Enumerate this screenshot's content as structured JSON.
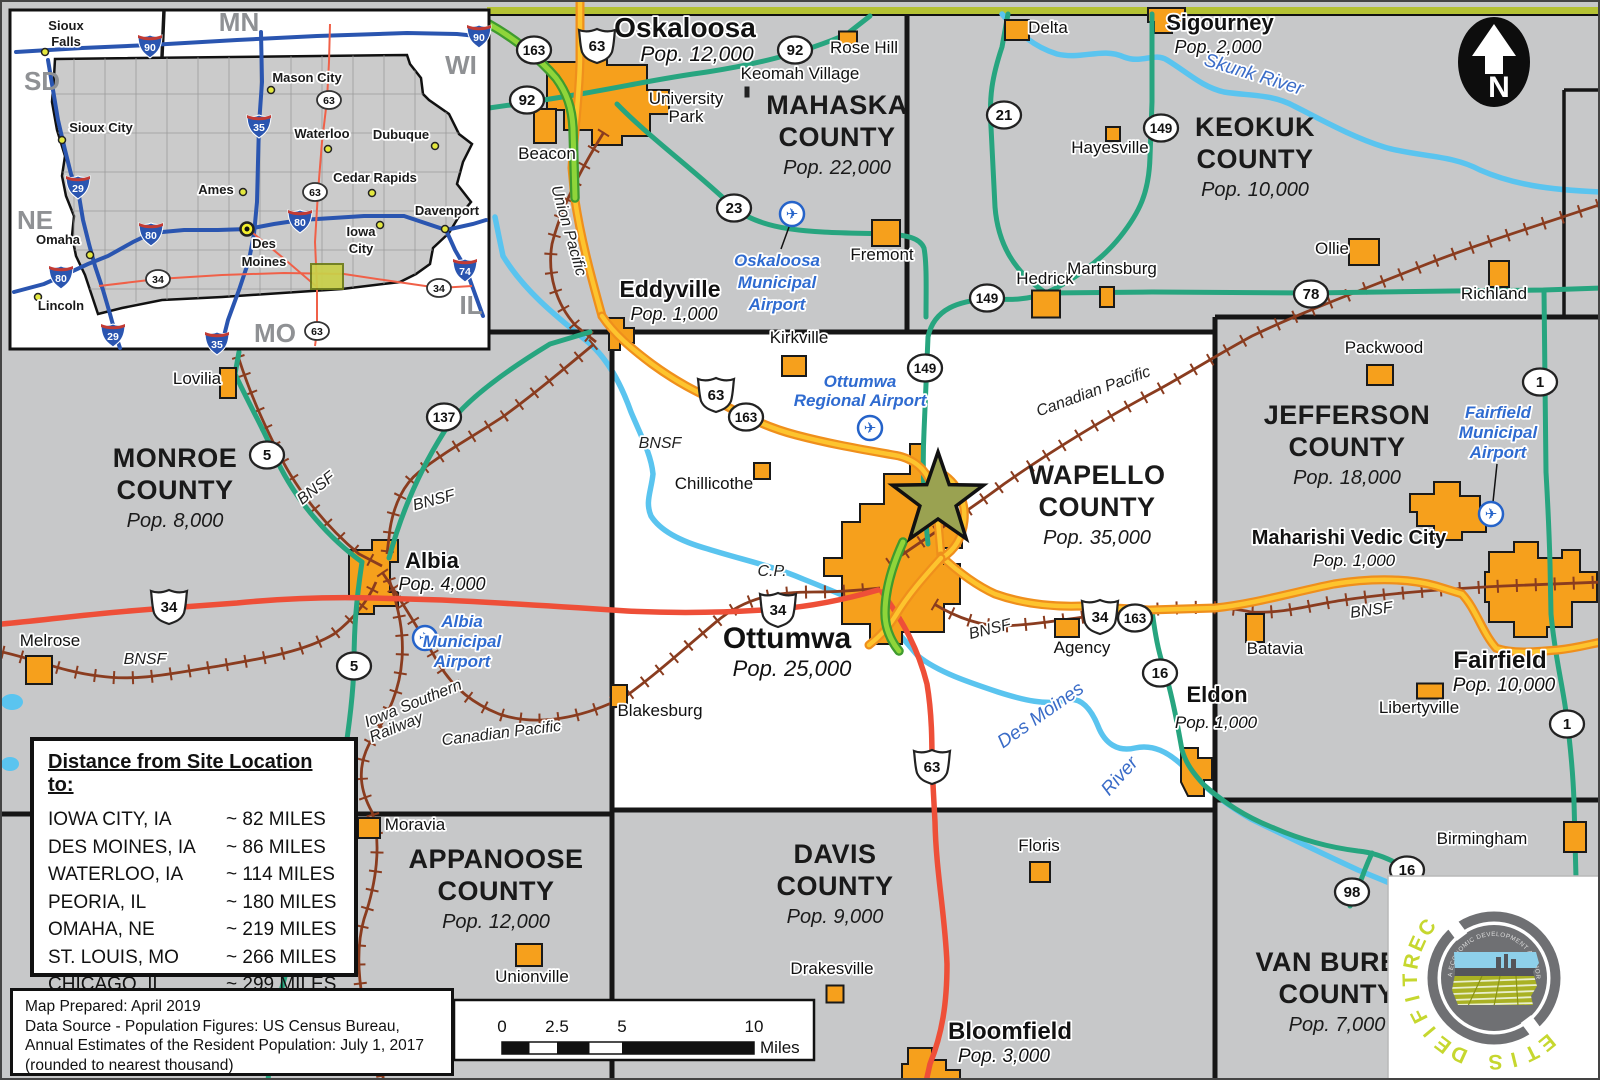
{
  "colors": {
    "town": "#f6a01c",
    "road_teal": "#27a57f",
    "road_yellow": "#fdc42e",
    "road_red": "#ee4f38",
    "road_lime": "#8fd53a",
    "rail": "#8a3c1f",
    "river": "#5ac4ef",
    "star": "#9aa251",
    "logo_green": "#c6d72f",
    "accent_olive": "#b5c234"
  },
  "map": {
    "north_label": "N",
    "site_marker": "site-location-star",
    "counties": [
      {
        "lines": [
          "MAHASKA",
          "COUNTY"
        ],
        "pop": "Pop. 22,000",
        "x": 835,
        "y": 112
      },
      {
        "lines": [
          "KEOKUK",
          "COUNTY"
        ],
        "pop": "Pop. 10,000",
        "x": 1253,
        "y": 134
      },
      {
        "lines": [
          "MONROE",
          "COUNTY"
        ],
        "pop": "Pop. 8,000",
        "x": 173,
        "y": 465
      },
      {
        "lines": [
          "WAPELLO",
          "COUNTY"
        ],
        "pop": "Pop. 35,000",
        "x": 1095,
        "y": 482
      },
      {
        "lines": [
          "JEFFERSON",
          "COUNTY"
        ],
        "pop": "Pop. 18,000",
        "x": 1345,
        "y": 422
      },
      {
        "lines": [
          "APPANOOSE",
          "COUNTY"
        ],
        "pop": "Pop. 12,000",
        "x": 494,
        "y": 866
      },
      {
        "lines": [
          "DAVIS",
          "COUNTY"
        ],
        "pop": "Pop. 9,000",
        "x": 833,
        "y": 861
      },
      {
        "lines": [
          "VAN BUREN",
          "COUNTY"
        ],
        "pop": "Pop. 7,000",
        "x": 1335,
        "y": 969
      }
    ],
    "towns": [
      {
        "n": "Oskaloosa",
        "x": 683,
        "y": 35,
        "s": 28,
        "b": 1,
        "pop": "Pop. 12,000",
        "px": 695,
        "py": 59,
        "ps": 21
      },
      {
        "n": "University Park",
        "lines": [
          "University",
          "Park"
        ],
        "x": 684,
        "y": 102,
        "s": 17,
        "dy": 18
      },
      {
        "n": "Beacon",
        "x": 545,
        "y": 157,
        "s": 17,
        "m": [
          543,
          124,
          22,
          34
        ]
      },
      {
        "n": "Keomah Village",
        "x": 798,
        "y": 77,
        "s": 17,
        "m": [
          745,
          90,
          5,
          11
        ],
        "dark": 1
      },
      {
        "n": "Rose Hill",
        "x": 862,
        "y": 51,
        "s": 17,
        "m": [
          846,
          36,
          18,
          13
        ]
      },
      {
        "n": "Delta",
        "x": 1046,
        "y": 31,
        "s": 17,
        "m": [
          1015,
          28,
          24,
          20
        ]
      },
      {
        "n": "Sigourney",
        "x": 1218,
        "y": 28,
        "s": 22,
        "b": 1,
        "pop": "Pop. 2,000",
        "px": 1216,
        "py": 51,
        "ps": 18
      },
      {
        "n": "Hayesville",
        "x": 1108,
        "y": 151,
        "s": 17,
        "m": [
          1111,
          132,
          14,
          14
        ]
      },
      {
        "n": "Hedrick",
        "x": 1043,
        "y": 282,
        "s": 17,
        "m": [
          1044,
          302,
          28,
          27
        ]
      },
      {
        "n": "Martinsburg",
        "x": 1110,
        "y": 272,
        "s": 17,
        "m": [
          1105,
          295,
          14,
          20
        ]
      },
      {
        "n": "Ollie",
        "x": 1330,
        "y": 252,
        "s": 17,
        "m": [
          1362,
          250,
          30,
          26
        ]
      },
      {
        "n": "Richland",
        "x": 1492,
        "y": 297,
        "s": 17,
        "m": [
          1497,
          272,
          20,
          26
        ]
      },
      {
        "n": "Packwood",
        "x": 1382,
        "y": 351,
        "s": 17,
        "m": [
          1378,
          373,
          26,
          20
        ]
      },
      {
        "n": "Fremont",
        "x": 880,
        "y": 258,
        "s": 17,
        "m": [
          884,
          231,
          28,
          26
        ]
      },
      {
        "n": "Eddyville",
        "x": 668,
        "y": 295,
        "s": 23,
        "b": 1,
        "pop": "Pop. 1,000",
        "px": 672,
        "py": 318,
        "ps": 18
      },
      {
        "n": "Kirkville",
        "x": 797,
        "y": 341,
        "s": 17,
        "m": [
          792,
          364,
          24,
          20
        ]
      },
      {
        "n": "Chillicothe",
        "x": 712,
        "y": 487,
        "s": 17,
        "m": [
          760,
          469,
          16,
          16
        ]
      },
      {
        "n": "Lovilia",
        "x": 195,
        "y": 382,
        "s": 17,
        "m": [
          226,
          381,
          16,
          30
        ]
      },
      {
        "n": "Albia",
        "x": 430,
        "y": 566,
        "s": 22,
        "b": 1,
        "pop": "Pop. 4,000",
        "px": 440,
        "py": 588,
        "ps": 18
      },
      {
        "n": "Melrose",
        "x": 48,
        "y": 644,
        "s": 17,
        "m": [
          37,
          668,
          26,
          28
        ]
      },
      {
        "n": "Blakesburg",
        "x": 658,
        "y": 714,
        "s": 17,
        "m": [
          617,
          694,
          16,
          22
        ]
      },
      {
        "n": "Moravia",
        "x": 413,
        "y": 828,
        "s": 17,
        "m": [
          367,
          826,
          22,
          20
        ]
      },
      {
        "n": "Unionville",
        "x": 530,
        "y": 980,
        "s": 17,
        "m": [
          527,
          953,
          26,
          22
        ]
      },
      {
        "n": "Drakesville",
        "x": 830,
        "y": 972,
        "s": 17,
        "m": [
          833,
          992,
          17,
          17
        ]
      },
      {
        "n": "Floris",
        "x": 1037,
        "y": 849,
        "s": 17,
        "m": [
          1038,
          870,
          20,
          20
        ]
      },
      {
        "n": "Bloomfield",
        "x": 1008,
        "y": 1037,
        "s": 24,
        "b": 1,
        "pop": "Pop. 3,000",
        "px": 1002,
        "py": 1060,
        "ps": 19
      },
      {
        "n": "Eldon",
        "x": 1215,
        "y": 700,
        "s": 22,
        "b": 1,
        "pop": "Pop. 1,000",
        "px": 1214,
        "py": 726,
        "ps": 17
      },
      {
        "n": "Agency",
        "x": 1080,
        "y": 651,
        "s": 17,
        "m": [
          1065,
          626,
          24,
          18
        ]
      },
      {
        "n": "Batavia",
        "x": 1273,
        "y": 652,
        "s": 17,
        "m": [
          1253,
          626,
          18,
          28
        ]
      },
      {
        "n": "Maharishi Vedic City",
        "x": 1347,
        "y": 542,
        "s": 20,
        "b": 1,
        "pop": "Pop. 1,000",
        "px": 1352,
        "py": 564,
        "ps": 17
      },
      {
        "n": "Fairfield",
        "x": 1498,
        "y": 666,
        "s": 24,
        "b": 1,
        "pop": "Pop. 10,000",
        "px": 1502,
        "py": 689,
        "ps": 19
      },
      {
        "n": "Libertyville",
        "x": 1417,
        "y": 711,
        "s": 17,
        "m": [
          1428,
          689,
          26,
          15
        ]
      },
      {
        "n": "Birmingham",
        "x": 1480,
        "y": 842,
        "s": 17,
        "m": [
          1573,
          835,
          22,
          30
        ]
      },
      {
        "n": "Ottumwa",
        "x": 785,
        "y": 646,
        "s": 30,
        "b": 1,
        "pop": "Pop. 25,000",
        "px": 790,
        "py": 674,
        "ps": 22
      }
    ],
    "airports": [
      {
        "lines": [
          "Oskaloosa",
          "Municipal",
          "Airport"
        ],
        "x": 775,
        "y": 264,
        "dy": 22,
        "icon": [
          790,
          212
        ],
        "leader": [
          787,
          225,
          779,
          247
        ]
      },
      {
        "lines": [
          "Ottumwa",
          "Regional Airport"
        ],
        "x": 858,
        "y": 385,
        "dy": 19,
        "icon": [
          868,
          426
        ]
      },
      {
        "lines": [
          "Albia",
          "Municipal",
          "Airport"
        ],
        "x": 460,
        "y": 625,
        "dy": 20,
        "icon": [
          423,
          636
        ]
      },
      {
        "lines": [
          "Fairfield",
          "Municipal",
          "Airport"
        ],
        "x": 1496,
        "y": 416,
        "dy": 20,
        "icon": [
          1489,
          512
        ],
        "leader": [
          1495,
          462,
          1491,
          500
        ]
      }
    ],
    "shields_state": [
      [
        532,
        48,
        "163"
      ],
      [
        525,
        98,
        "92"
      ],
      [
        793,
        48,
        "92"
      ],
      [
        1002,
        113,
        "21"
      ],
      [
        1159,
        126,
        "149"
      ],
      [
        732,
        206,
        "23"
      ],
      [
        985,
        296,
        "149"
      ],
      [
        1309,
        292,
        "78"
      ],
      [
        1538,
        380,
        "1"
      ],
      [
        744,
        415,
        "163"
      ],
      [
        923,
        366,
        "149"
      ],
      [
        442,
        415,
        "137"
      ],
      [
        265,
        453,
        "5"
      ],
      [
        352,
        664,
        "5"
      ],
      [
        1133,
        616,
        "163"
      ],
      [
        1158,
        671,
        "16"
      ],
      [
        1405,
        868,
        "16"
      ],
      [
        1350,
        890,
        "98"
      ],
      [
        1565,
        722,
        "1"
      ]
    ],
    "shields_us": [
      [
        595,
        43,
        "63"
      ],
      [
        714,
        392,
        "63"
      ],
      [
        167,
        604,
        "34"
      ],
      [
        776,
        607,
        "34"
      ],
      [
        1098,
        614,
        "34"
      ],
      [
        930,
        764,
        "63"
      ]
    ],
    "rail_labels": [
      [
        "Union Pacific",
        562,
        230,
        74
      ],
      [
        "BNSF",
        317,
        490,
        -38
      ],
      [
        "BNSF",
        433,
        503,
        -15
      ],
      [
        "BNSF",
        658,
        446,
        0
      ],
      [
        "BNSF",
        143,
        662,
        0
      ],
      [
        "BNSF",
        989,
        632,
        -14
      ],
      [
        "BNSF",
        1370,
        613,
        -8
      ],
      [
        "Canadian Pacific",
        1093,
        394,
        -20
      ],
      [
        "Canadian Pacific",
        500,
        736,
        -7
      ],
      [
        "Iowa Southern",
        413,
        706,
        -22
      ],
      [
        "Railway",
        396,
        730,
        -22
      ],
      [
        "C.P.",
        770,
        574,
        0
      ]
    ],
    "river_labels": [
      [
        "Skunk River",
        1250,
        78,
        17
      ],
      [
        "Des Moines",
        1042,
        718,
        -35
      ],
      [
        "River",
        1122,
        778,
        -48
      ]
    ]
  },
  "inset": {
    "states": [
      [
        "MN",
        237,
        29
      ],
      [
        "WI",
        459,
        72
      ],
      [
        "SD",
        40,
        88
      ],
      [
        "NE",
        33,
        227
      ],
      [
        "MO",
        273,
        340
      ],
      [
        "IL",
        469,
        312
      ]
    ],
    "cities": [
      {
        "lines": [
          "Sioux",
          "Falls"
        ],
        "x": 64,
        "y": 28,
        "dy": 16,
        "dot": [
          43,
          50
        ]
      },
      {
        "lines": [
          "Mason City"
        ],
        "x": 305,
        "y": 80,
        "dot": [
          269,
          88
        ]
      },
      {
        "lines": [
          "Sioux City"
        ],
        "x": 99,
        "y": 130,
        "dot": [
          60,
          138
        ]
      },
      {
        "lines": [
          "Waterloo"
        ],
        "x": 320,
        "y": 136,
        "dot": [
          326,
          147
        ]
      },
      {
        "lines": [
          "Dubuque"
        ],
        "x": 399,
        "y": 137,
        "dot": [
          433,
          144
        ]
      },
      {
        "lines": [
          "Ames"
        ],
        "x": 214,
        "y": 192,
        "dot": [
          241,
          190
        ]
      },
      {
        "lines": [
          "Cedar Rapids"
        ],
        "x": 373,
        "y": 180,
        "dot": [
          370,
          191
        ]
      },
      {
        "lines": [
          "Davenport"
        ],
        "x": 445,
        "y": 213,
        "dot": [
          443,
          227
        ]
      },
      {
        "lines": [
          "Des",
          "Moines"
        ],
        "x": 262,
        "y": 246,
        "dy": 18,
        "cap": [
          245,
          227
        ]
      },
      {
        "lines": [
          "Iowa",
          "City"
        ],
        "x": 359,
        "y": 234,
        "dy": 17,
        "dot": [
          378,
          223
        ]
      },
      {
        "lines": [
          "Omaha"
        ],
        "x": 56,
        "y": 242,
        "dot": [
          88,
          253
        ]
      },
      {
        "lines": [
          "Lincoln"
        ],
        "x": 59,
        "y": 308,
        "dot": [
          36,
          295
        ]
      }
    ],
    "interstate_shields": [
      [
        148,
        43,
        "90"
      ],
      [
        477,
        33,
        "90"
      ],
      [
        257,
        123,
        "35"
      ],
      [
        76,
        184,
        "29"
      ],
      [
        298,
        218,
        "80"
      ],
      [
        149,
        231,
        "80"
      ],
      [
        59,
        274,
        "80"
      ],
      [
        463,
        267,
        "74"
      ],
      [
        111,
        332,
        "29"
      ],
      [
        215,
        340,
        "35"
      ]
    ],
    "us_ovals": [
      [
        327,
        98,
        "63"
      ],
      [
        313,
        190,
        "63"
      ],
      [
        156,
        277,
        "34"
      ],
      [
        437,
        286,
        "34"
      ],
      [
        315,
        329,
        "63"
      ]
    ]
  },
  "distance_panel": {
    "title": "Distance from Site Location to:",
    "rows": [
      [
        "IOWA CITY, IA",
        "~ 82 MILES"
      ],
      [
        "DES MOINES, IA",
        "~ 86 MILES"
      ],
      [
        "WATERLOO, IA",
        "~ 114 MILES"
      ],
      [
        "PEORIA, IL",
        "~ 180 MILES"
      ],
      [
        "OMAHA, NE",
        "~ 219 MILES"
      ],
      [
        "ST. LOUIS, MO",
        "~ 266 MILES"
      ],
      [
        "CHICAGO, IL",
        "~ 299 MILES"
      ]
    ]
  },
  "footer": {
    "lines": [
      "Map Prepared: April 2019",
      "Data Source - Population Figures: US Census Bureau,",
      "Annual Estimates of the Resident Population: July 1, 2017",
      "(rounded to nearest thousand)"
    ]
  },
  "scale": {
    "ticks": [
      [
        "0",
        500
      ],
      [
        "2.5",
        555
      ],
      [
        "5",
        620
      ],
      [
        "10",
        752
      ]
    ],
    "unit": "Miles"
  },
  "logo": {
    "arc": "CERTIFIED SITE",
    "ring": "IOWA ECONOMIC DEVELOPMENT AUTHORITY"
  }
}
